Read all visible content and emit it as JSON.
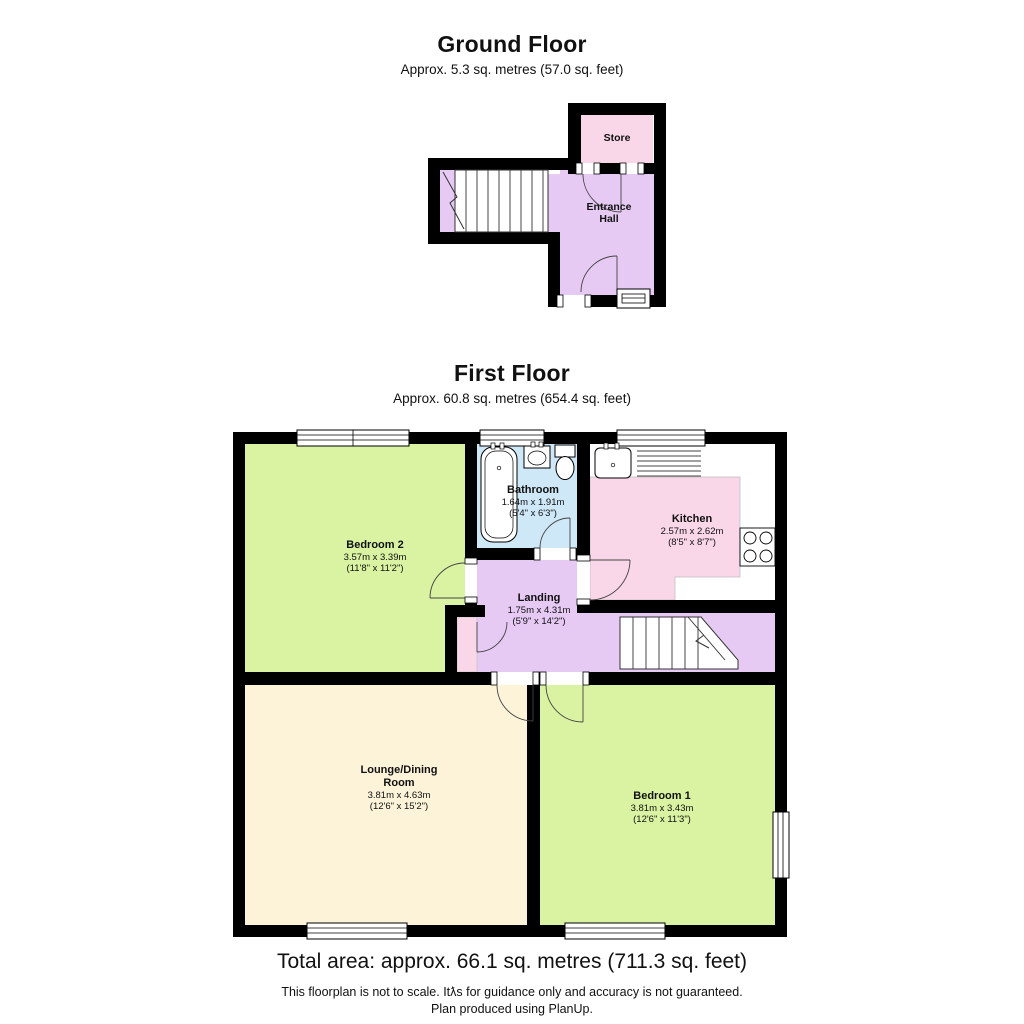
{
  "ground_floor": {
    "title": "Ground Floor",
    "subtitle": "Approx. 5.3 sq. metres (57.0 sq. feet)",
    "rooms": [
      {
        "name": "Store"
      },
      {
        "name": "Entrance Hall"
      }
    ]
  },
  "first_floor": {
    "title": "First Floor",
    "subtitle": "Approx. 60.8 sq. metres (654.4 sq. feet)",
    "rooms": [
      {
        "name": "Bedroom 2",
        "metric": "3.57m x 3.39m",
        "imperial": "(11'8\" x 11'2\")"
      },
      {
        "name": "Bathroom",
        "metric": "1.64m x 1.91m",
        "imperial": "(5'4\" x 6'3\")"
      },
      {
        "name": "Kitchen",
        "metric": "2.57m x 2.62m",
        "imperial": "(8'5\" x 8'7\")"
      },
      {
        "name": "Landing",
        "metric": "1.75m x 4.31m",
        "imperial": "(5'9\" x 14'2\")"
      },
      {
        "name": "Lounge/Dining Room",
        "metric": "3.81m x 4.63m",
        "imperial": "(12'6\" x 15'2\")"
      },
      {
        "name": "Bedroom 1",
        "metric": "3.81m x 3.43m",
        "imperial": "(12'6\" x 11'3\")"
      }
    ]
  },
  "footer": {
    "total_area": "Total area: approx. 66.1 sq. metres (711.3 sq. feet)",
    "disclaimer": "This floorplan is not to scale. Itƛs for guidance only and accuracy is not guaranteed.",
    "credit": "Plan produced using PlanUp."
  },
  "colors": {
    "wall": "#000000",
    "bedroom_green": "#d9f3a2",
    "lounge_cream": "#fcf3d9",
    "kitchen_store_pink": "#f9d7e9",
    "landing_hall_lavender": "#e6caf4",
    "bathroom_blue": "#cfe8f7",
    "fixture_line": "#333333"
  }
}
